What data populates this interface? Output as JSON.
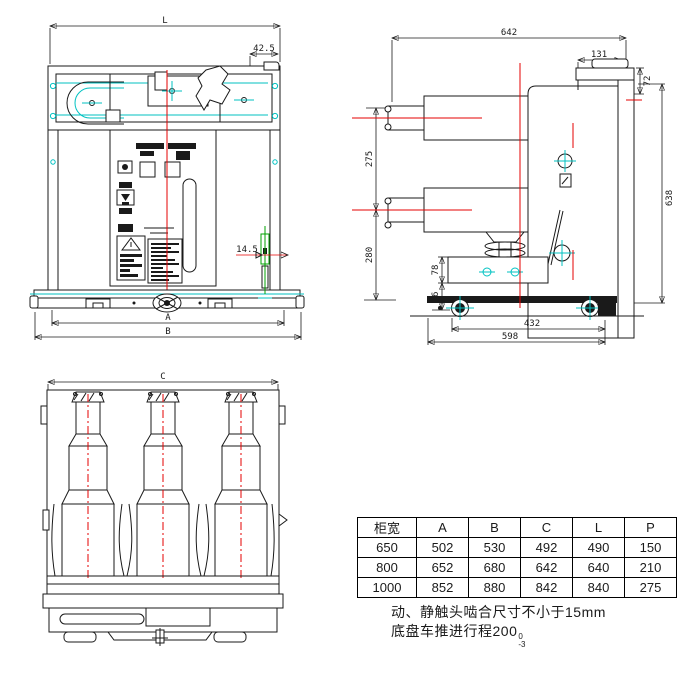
{
  "title": "vacuum-circuit-breaker-outline-drawing",
  "front_view": {
    "dims": {
      "L": "L",
      "corner": "42.5",
      "A": "A",
      "B": "B",
      "engagement": "14.5"
    },
    "colors": {
      "indicator_red": "#e80000",
      "indicator_green": "#00c300",
      "centerline_red": "#e60000",
      "construction_cyan": "#00c2c2",
      "interlock_green": "#00a000"
    }
  },
  "side_view": {
    "dims": {
      "total_width": "642",
      "bracket_width": "131",
      "bracket_height": "72",
      "pole_spacing": "275",
      "lower_height": "280",
      "box_height": "78",
      "wheel_height": "76",
      "total_height": "638",
      "wheel_base": "432",
      "base_length": "598"
    }
  },
  "bottom_view": {
    "dims": {
      "C": "C",
      "P_left": "P",
      "P_right": "P"
    }
  },
  "table": {
    "headers": [
      "柜宽",
      "A",
      "B",
      "C",
      "L",
      "P"
    ],
    "rows": [
      [
        "650",
        "502",
        "530",
        "492",
        "490",
        "150"
      ],
      [
        "800",
        "652",
        "680",
        "642",
        "640",
        "210"
      ],
      [
        "1000",
        "852",
        "880",
        "842",
        "840",
        "275"
      ]
    ]
  },
  "notes": {
    "line1": "动、静触头啮合尺寸不小于15mm",
    "line2_text": "底盘车推进行程200",
    "line2_tol_upper": "0",
    "line2_tol_lower": "-3"
  }
}
